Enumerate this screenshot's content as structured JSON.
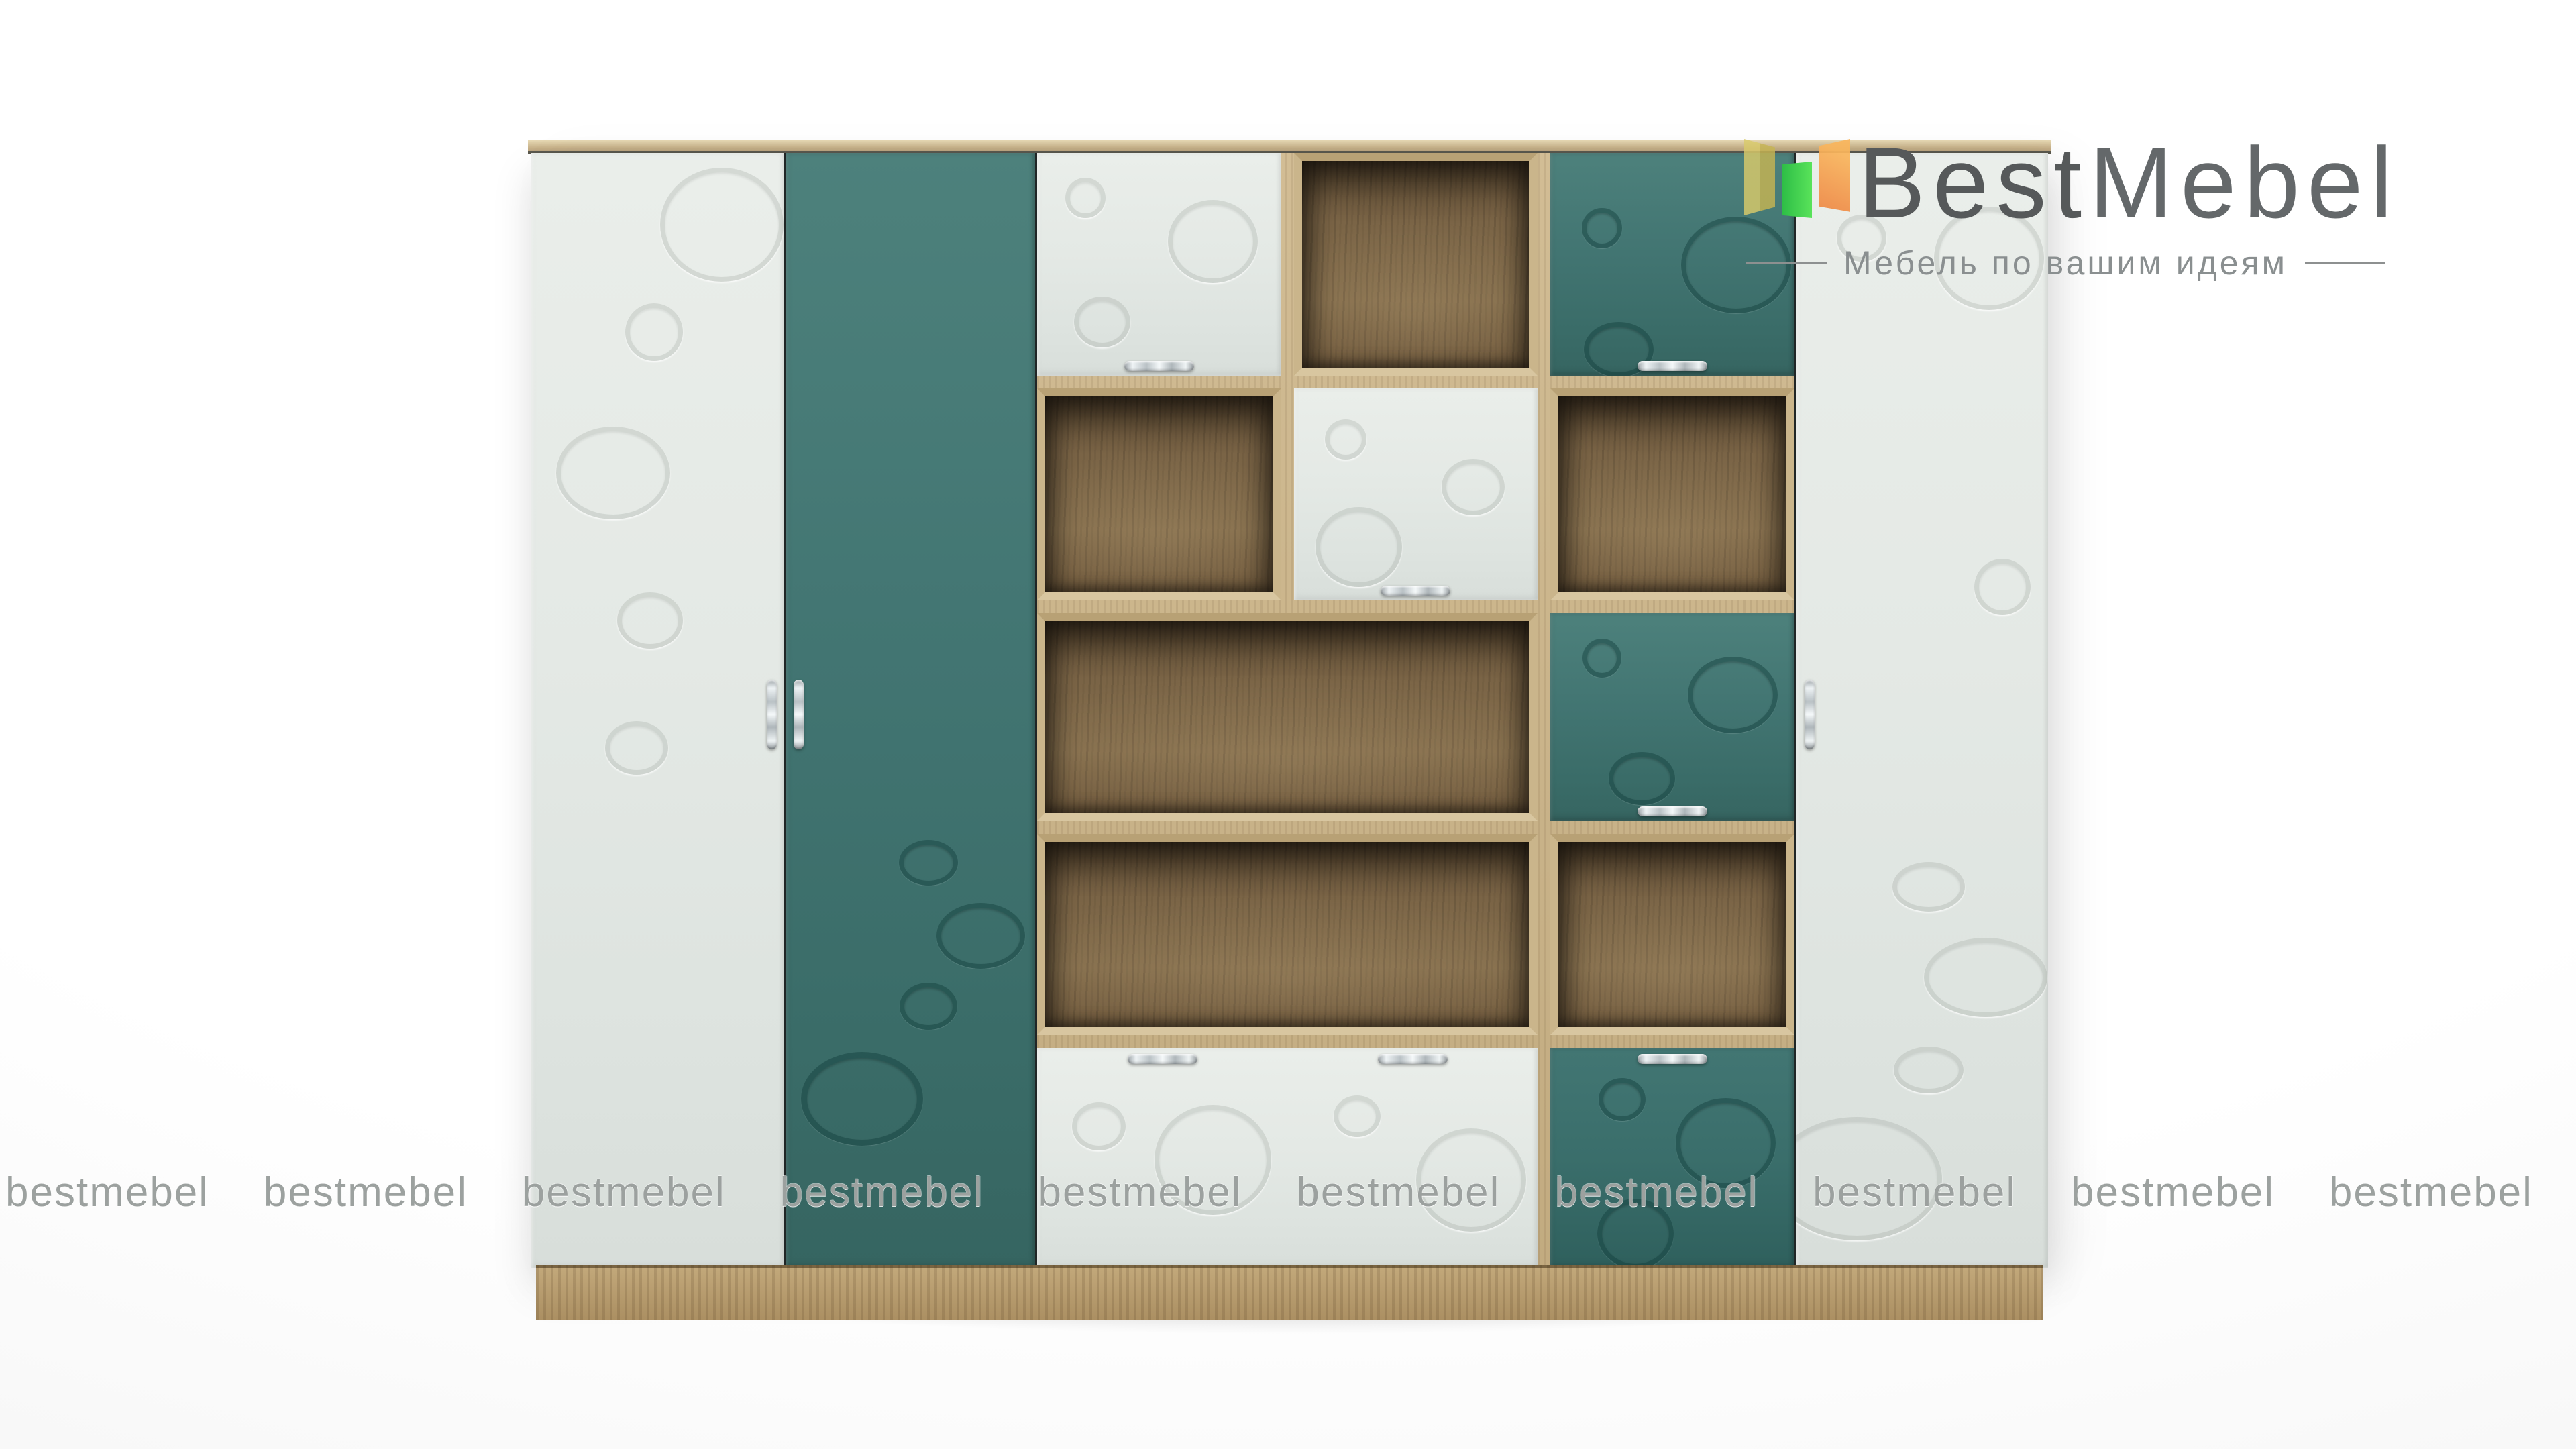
{
  "brand": {
    "name_primary": "Best",
    "name_secondary": "Mebel",
    "tagline": "Мебель по вашим идеям",
    "text_color": "#56595a",
    "tagline_color": "#8a8f90",
    "icon_colors": {
      "yellow": "#d9ca6a",
      "green": "#3ad04e",
      "orange": "#f4a251"
    }
  },
  "watermark": {
    "text": "bestmebel",
    "count": 10,
    "color": "#949997"
  },
  "product": {
    "colors": {
      "facade_white": "#e4e9e5",
      "facade_teal": "#427572",
      "carcass_wood_light": "#c8b289",
      "interior_wood_dark": "#7a6446",
      "plinth_wood": "#b4996c",
      "handle_chrome": "#d9dfe1"
    }
  }
}
